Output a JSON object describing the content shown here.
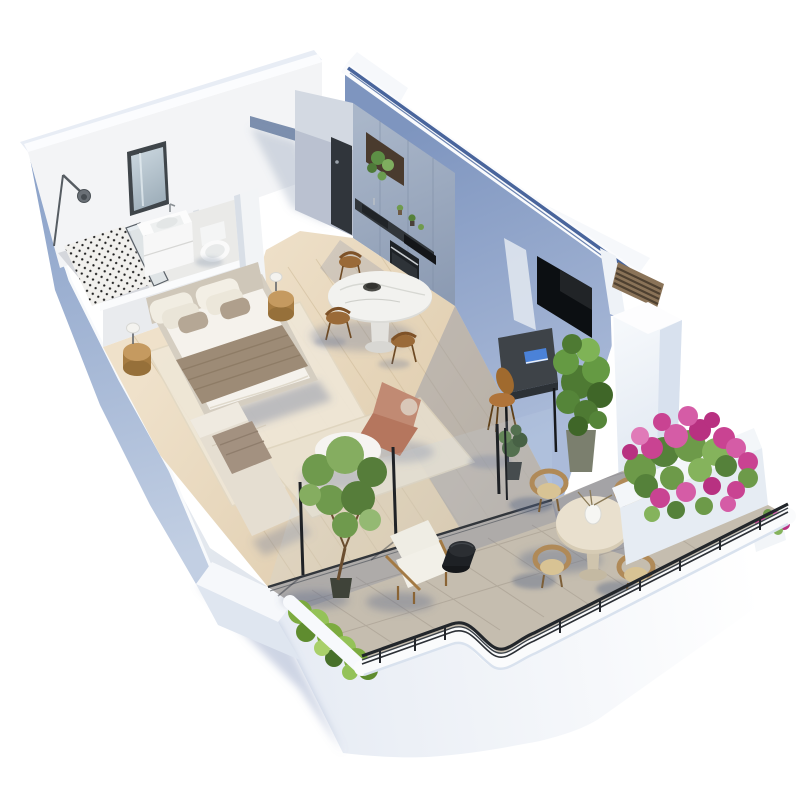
{
  "scene": {
    "type": "isometric-3d-floor-plan-render",
    "subject": "studio apartment cutaway with wraparound terrace",
    "background": "#ffffff",
    "rooms": [
      {
        "name": "bathroom",
        "items": [
          "arc-wall-lamp",
          "wall-mirror",
          "vanity-with-sink",
          "wall-hung-toilet",
          "polka-dot-shower-floor",
          "glass-shower-screen",
          "toilet-paper-roll"
        ]
      },
      {
        "name": "bedroom",
        "items": [
          "double-bed",
          "headboard",
          "white-duvet",
          "taupe-throw-blanket",
          "pillows-x6",
          "drum-nightstand-left",
          "drum-nightstand-right",
          "table-lamp-left",
          "table-lamp-right",
          "area-rug"
        ]
      },
      {
        "name": "kitchen",
        "items": [
          "entry-door",
          "cabinet-run",
          "open-shelf-with-trailing-plant",
          "dark-countertop",
          "sink",
          "cooktop",
          "built-in-oven",
          "counter-plants"
        ]
      },
      {
        "name": "living-dining",
        "items": [
          "marble-pedestal-dining-table",
          "dark-fruit-bowl",
          "wooden-dining-chairs-x3",
          "terracotta-floor-lounger",
          "round-coffee-table",
          "bowl-of-limes",
          "upholstered-bench",
          "folded-towel",
          "wall-mounted-tv",
          "wall-desk",
          "blue-book",
          "wooden-desk-chair",
          "potted-green-plant",
          "small-dark-potted-plant",
          "area-rug",
          "sliding-glass-doors"
        ]
      },
      {
        "name": "terrace",
        "items": [
          "concrete-pavers",
          "potted-tree",
          "planter-with-shrubs",
          "outdoor-lounge-armchair",
          "black-side-table",
          "round-outdoor-dining-table",
          "white-vase-with-branches",
          "wicker-dining-chairs-x4",
          "bougainvillea-planter",
          "railing-flower-box",
          "curved-parapet",
          "black-metal-railing",
          "slatted-wood-screen",
          "white-pillar"
        ]
      }
    ],
    "counts": {
      "wicker_terrace_chairs": 4,
      "wooden_dining_chairs": 3,
      "nightstands": 2,
      "table_lamps": 2,
      "rugs": 2
    }
  },
  "palette": {
    "background": "#ffffff",
    "wall_white": "#f3f4f6",
    "wall_cap": "#fbfcfe",
    "exterior_shadow": "#93a9cd",
    "interior_blue_wall": "#8ea4c8",
    "accent_blue_line": "#49659c",
    "kitchen_cabinet": "#9fadc2",
    "counter_dark": "#31363b",
    "desk_top": "#3e4348",
    "entry_door": "#30353b",
    "tv_screen": "#0c0f12",
    "wood_floor": "#e7d8bd",
    "bathroom_floor": "#eaeae8",
    "shower_dot": "#1e1e1e",
    "terrace_floor": "#c5bdaf",
    "parapet_white": "#fafbfc",
    "railing_black": "#24272c",
    "bed_duvet": "#f5f2ec",
    "bed_throw": "#9d8b76",
    "bed_frame": "#d5cec1",
    "lounger_terracotta": "#c18a73",
    "marble_table": "#f2f2ef",
    "outdoor_table": "#e9e0ce",
    "wicker": "#b08a58",
    "cushion_white": "#f0eee6",
    "wood_furniture": "#b98a54",
    "walnut_chair": "#9a6a38",
    "plant_green": "#6f9a4d",
    "plant_dark": "#3f5a35",
    "flower_pink": "#cc4f9b",
    "shadow_blue": "rgba(96,110,148,0.32)"
  }
}
